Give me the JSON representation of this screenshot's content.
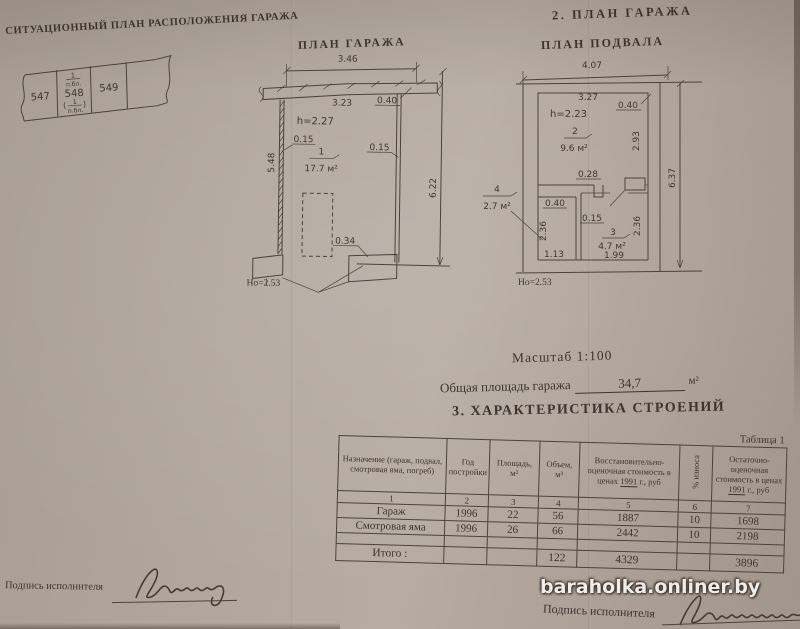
{
  "watermark": "baraholka.onliner.by",
  "situational": {
    "title": "СИТУАЦИОННЫЙ ПЛАН РАСПОЛОЖЕНИЯ ГАРАЖА",
    "plot_left": "547",
    "plot_center": "548",
    "plot_right": "549",
    "frac_top_num": "1",
    "frac_top_den": "п.бл.",
    "frac_bot_num": "1",
    "frac_bot_den": "п.бл.",
    "paren_open": "(",
    "paren_close": ")"
  },
  "garage_plan": {
    "title": "ПЛАН ГАРАЖА",
    "dim_top_width": "3.46",
    "dim_inner_width": "3.23",
    "dim_corner": "0.40",
    "ceiling_height": "h=2.27",
    "dim_wall_left": "0.15",
    "dim_wall_right": "0.15",
    "dim_side_left": "5.48",
    "dim_side_right": "6.22",
    "room_number": "1",
    "room_area": "17.7 м²",
    "dim_pier": "0.34",
    "base_height": "Но=2.53"
  },
  "basement_plan": {
    "section_title": "2. ПЛАН ГАРАЖА",
    "title": "ПЛАН ПОДВАЛА",
    "dim_top_width": "4.07",
    "dim_inner_width": "3.27",
    "dim_corner": "0.40",
    "ceiling_height": "h=2.23",
    "room2_number": "2",
    "room2_area": "9.6 м²",
    "dim_room2_height": "2.93",
    "dim_stub": "0.28",
    "room4_number": "4",
    "room4_area": "2.7 м²",
    "dim_wall": "0.40",
    "dim_partition": "0.15",
    "room3_number": "3",
    "room3_area": "4.7 м²",
    "dim_room4_height": "2.36",
    "dim_room3_height": "2.36",
    "dim_room4_width": "1.13",
    "dim_room3_width": "1.99",
    "dim_side_right": "6.37",
    "base_height": "Но=2.53"
  },
  "info": {
    "scale": "Масштаб 1:100",
    "total_area_label": "Общая площадь гаража",
    "total_area_value": "34,7",
    "total_area_unit": "м²",
    "section_title": "3. ХАРАКТЕРИСТИКА СТРОЕНИЙ"
  },
  "table": {
    "caption": "Таблица 1",
    "h_purpose": "Назначение (гараж, подвал, смотровая яма, погреб)",
    "h_year": "Год постройки",
    "h_area": "Площадь, м²",
    "h_volume": "Объем, м³",
    "h_cost_pre": "Восстановительно-оценочная стоимость в ценах",
    "h_cost_year": "1991",
    "h_cost_post": "г., руб",
    "h_wear": "% износа",
    "h_residual_pre": "Остаточно-оценочная стоимость в ценах",
    "h_residual_year": "1991",
    "h_residual_post": "г., руб",
    "nums": [
      "1",
      "2",
      "3",
      "4",
      "5",
      "6",
      "7"
    ],
    "rows": [
      {
        "name": "Гараж",
        "year": "1996",
        "area": "22",
        "volume": "56",
        "cost": "1887",
        "wear": "10",
        "residual": "1698"
      },
      {
        "name": "Смотровая яма",
        "year": "1996",
        "area": "26",
        "volume": "66",
        "cost": "2442",
        "wear": "10",
        "residual": "2198"
      }
    ],
    "total_label": "Итого :",
    "total_volume": "122",
    "total_cost": "4329",
    "total_residual": "3896"
  },
  "footer": {
    "sign_left_label": "Подпись исполнителя",
    "sign_right_label": "Подпись исполнителя"
  }
}
